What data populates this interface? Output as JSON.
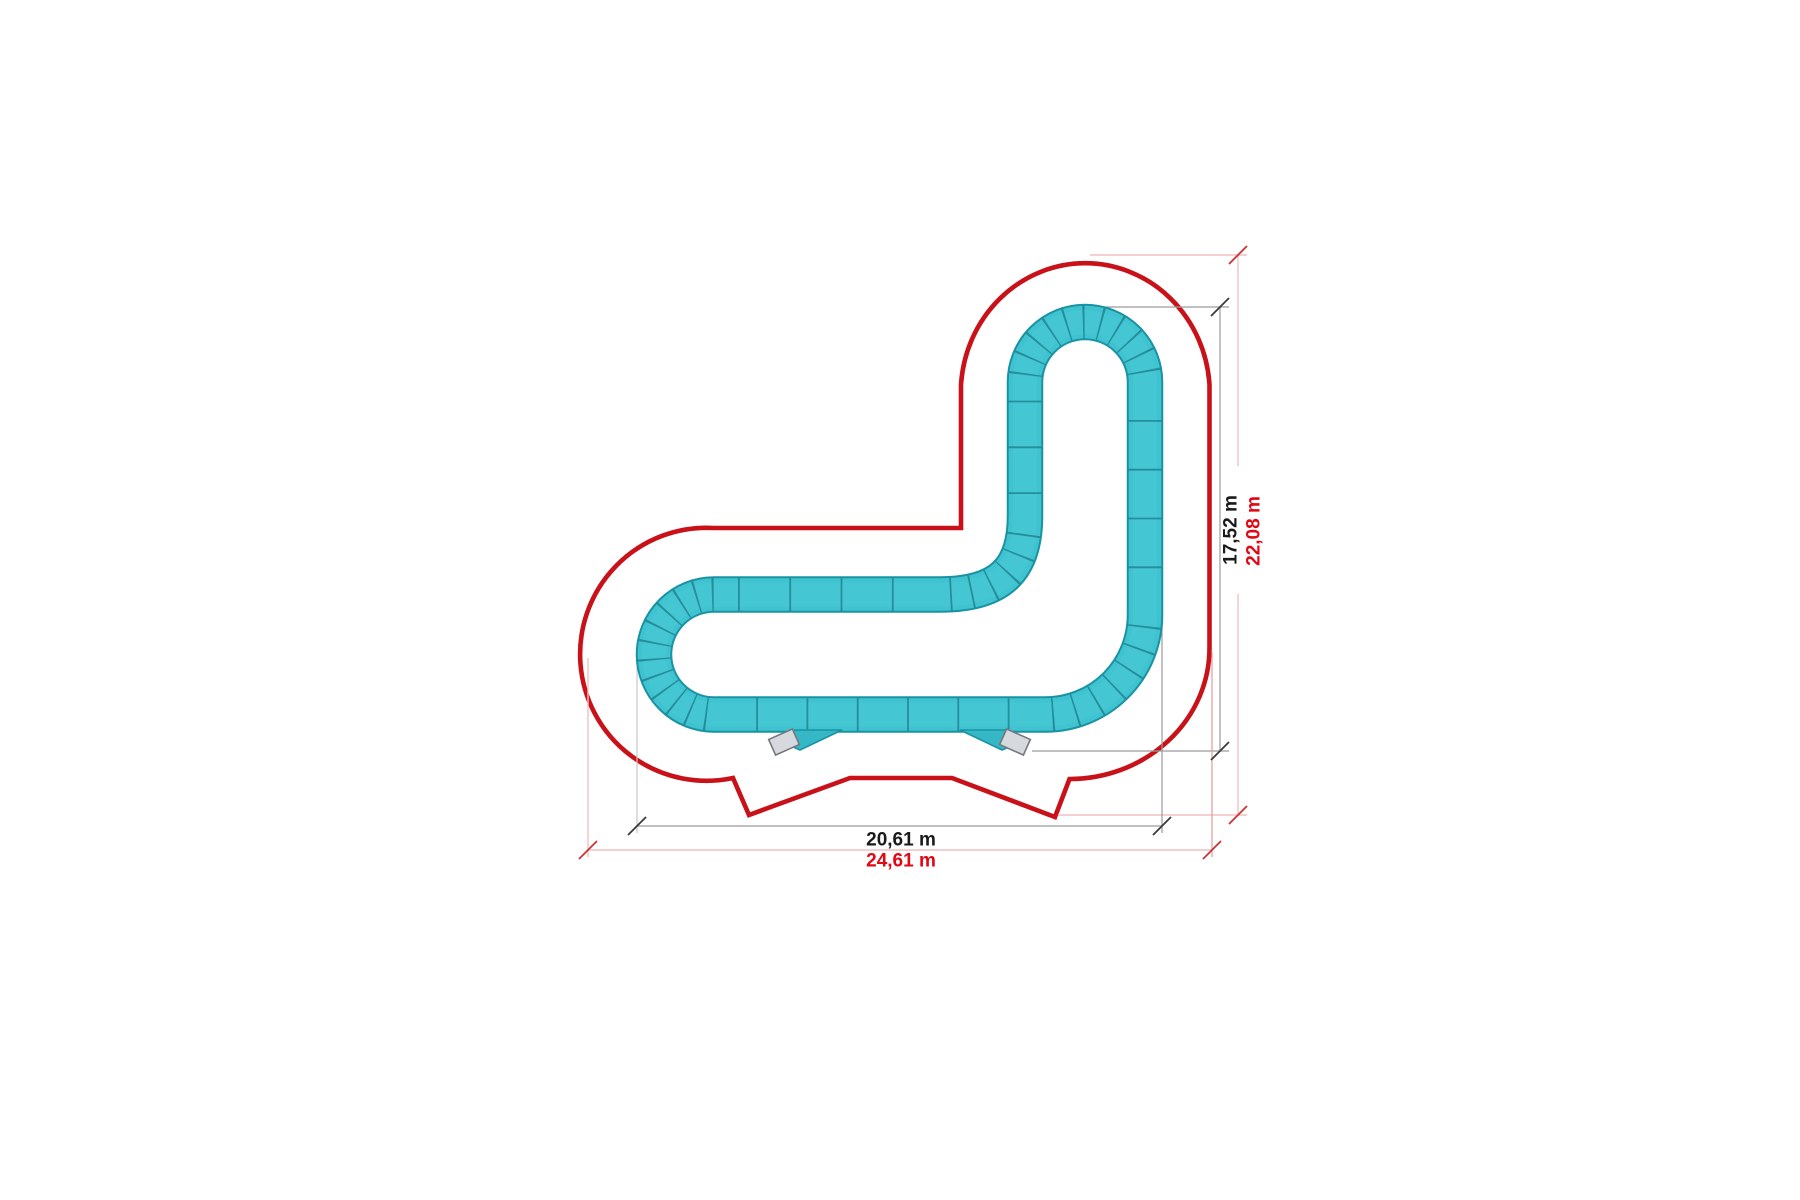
{
  "diagram": {
    "kind": "pump-track-dimension-plan",
    "dimensions": {
      "track_height": "17,52 m",
      "zone_height": "22,08 m",
      "track_width": "20,61 m",
      "zone_width": "24,61 m"
    },
    "start_ramp_count": 2,
    "colors": {
      "track_surface": "#3fc3d0",
      "track_edge": "#1993a2",
      "track_joint": "#1d7b89",
      "safety_zone_red": "#c81118",
      "dimension_red_text": "#e30613",
      "dimension_gray_line": "#9b9b9b",
      "dimension_pink_line": "#f0c2c2",
      "dimension_black_text": "#1a1a1a",
      "ramp_gray": "#d6dade"
    }
  }
}
